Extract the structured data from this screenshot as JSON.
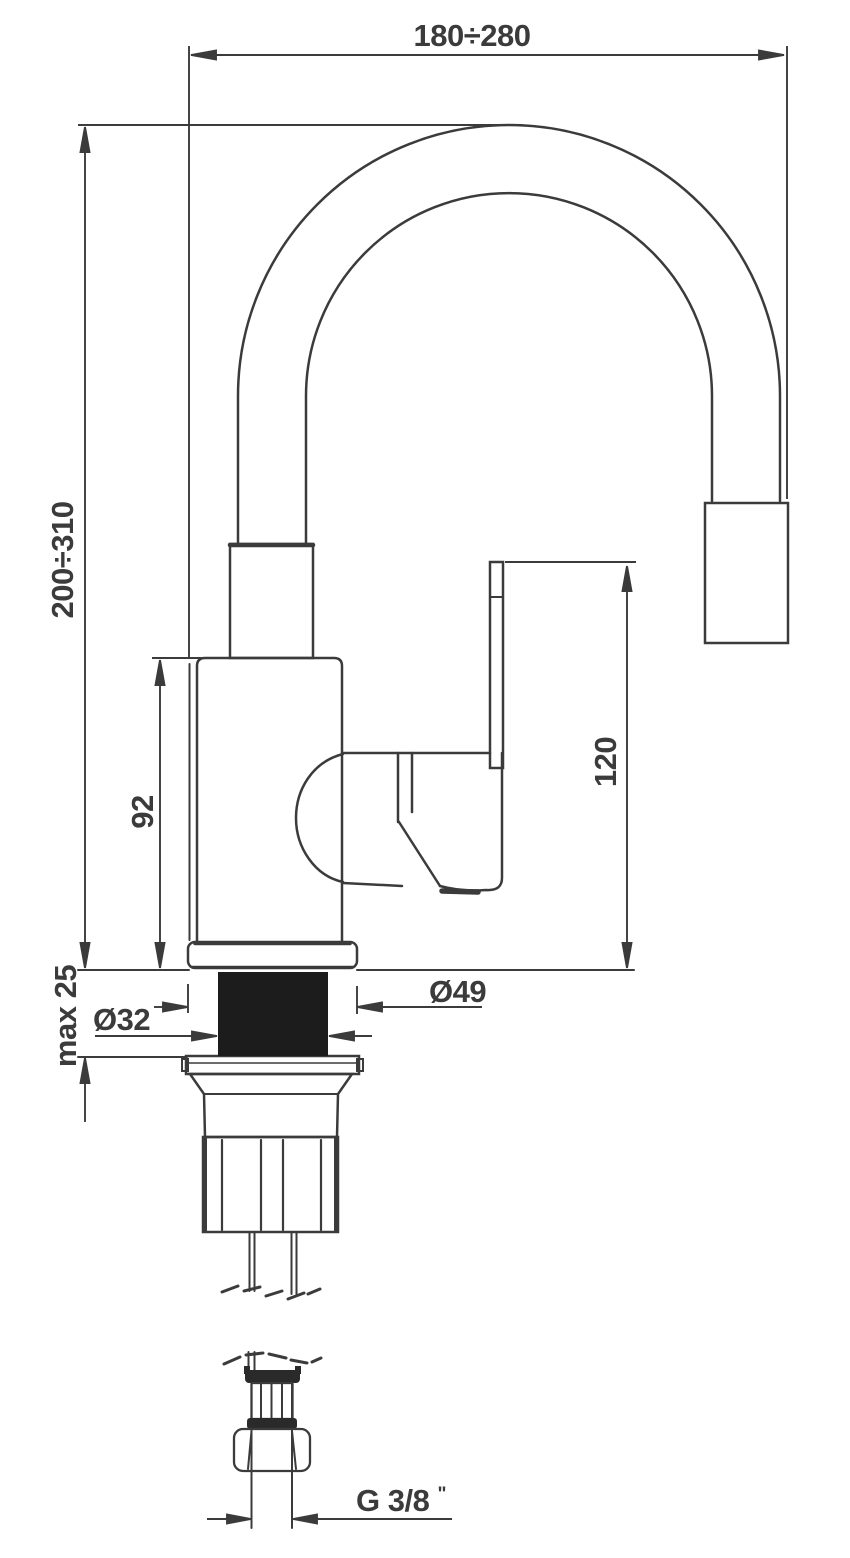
{
  "drawing": {
    "type": "faucet-dimensional-drawing",
    "labels": {
      "spout_reach": "180÷280",
      "spout_height": "200÷310",
      "body_height": "92",
      "handle_height": "120",
      "deck_thickness": "max 25",
      "hole_diameter": "Ø32",
      "base_diameter": "Ø49",
      "thread_size": "G 3/8",
      "thread_unit": "\""
    },
    "colors": {
      "line": "#3b3b3b",
      "section_fill": "#1c1c1c",
      "background": "#ffffff"
    }
  }
}
